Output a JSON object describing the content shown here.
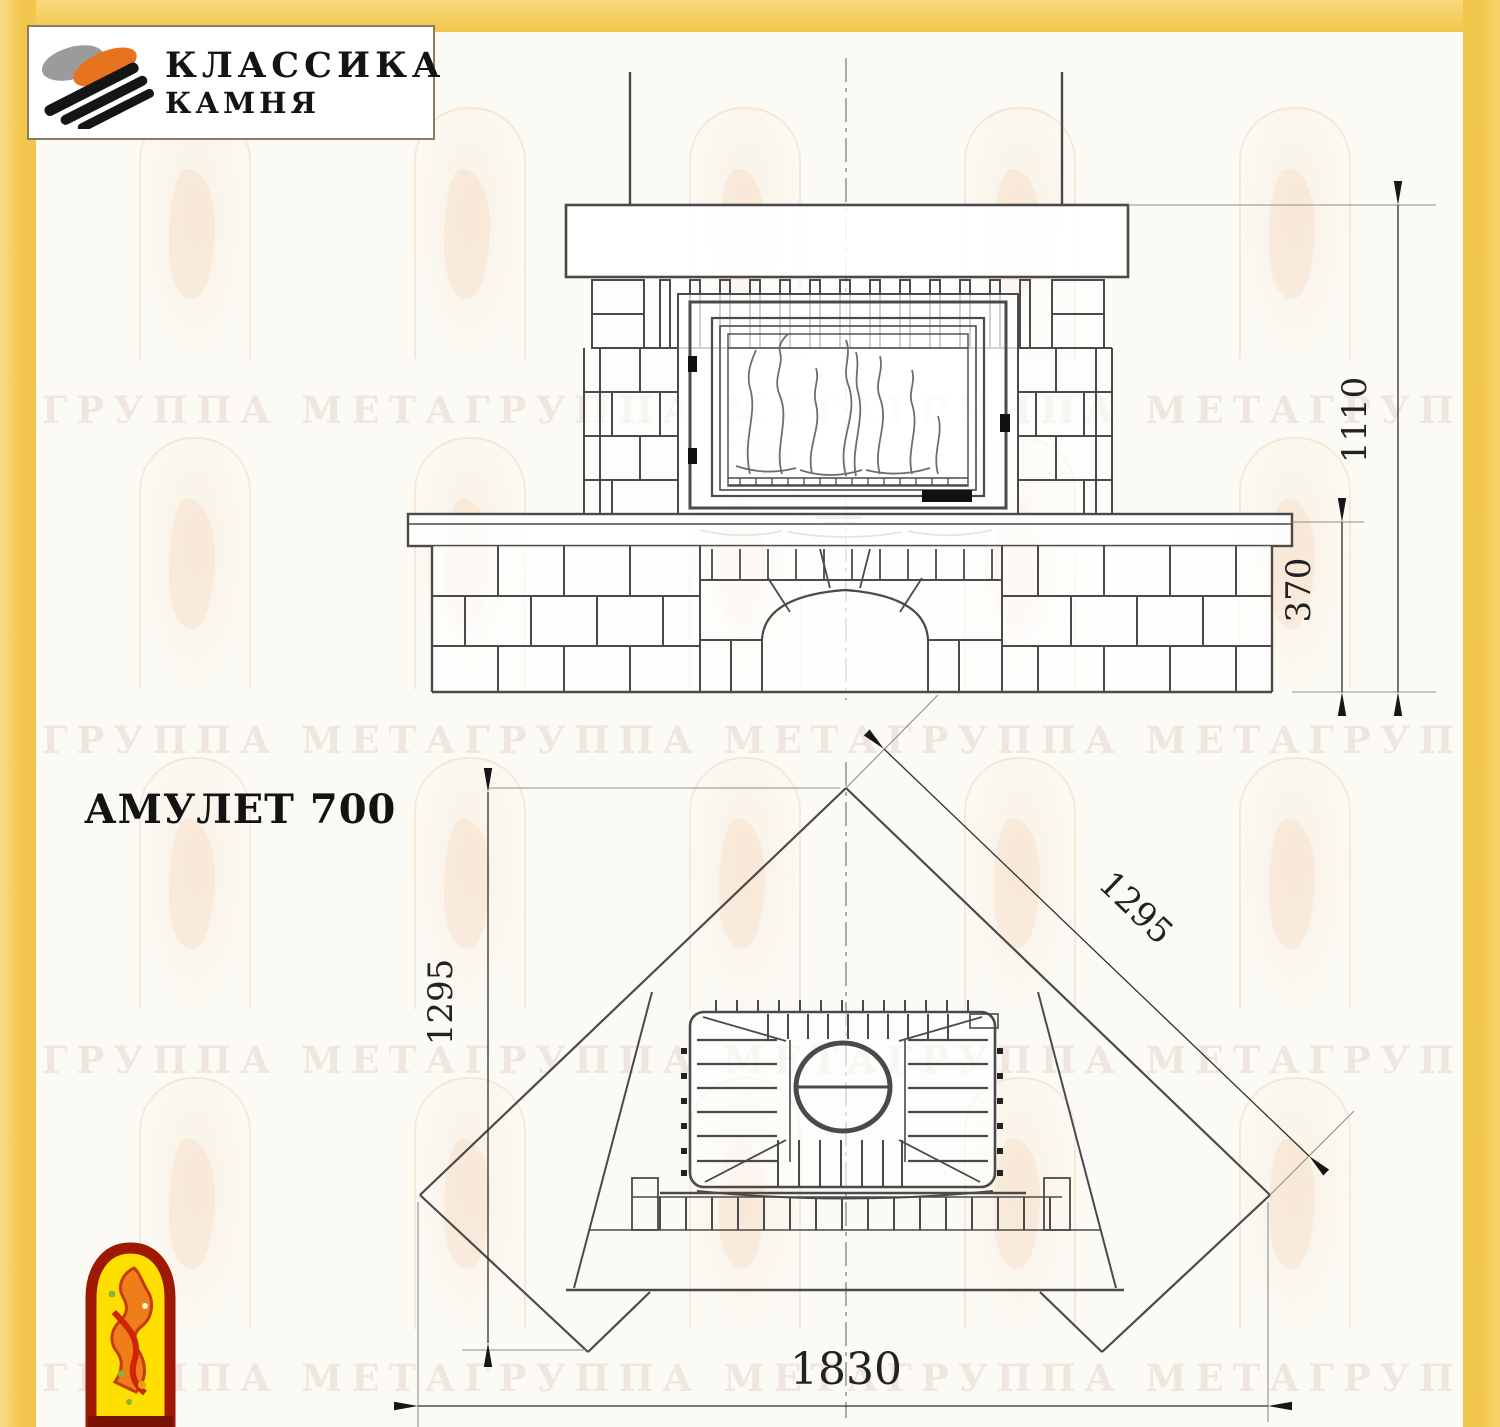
{
  "header": {
    "logo_line1": "КЛАССИКА",
    "logo_line2": "КАМНЯ"
  },
  "title": "АМУЛЕТ 700",
  "watermark": {
    "text": "ГРУППА МЕТАГРУППА МЕТАГРУППА МЕТАГРУППА МЕТАГРУППА МЕТА"
  },
  "front_view": {
    "dims": {
      "total_height": "1110",
      "bench_height": "370"
    }
  },
  "plan_view": {
    "dims": {
      "left_depth": "1295",
      "right_depth": "1295",
      "front_width": "1830"
    }
  },
  "colors": {
    "frame_yellow": "#f2c64c",
    "drawing_line": "#4a4a4a",
    "emblem_red": "#9e1803",
    "emblem_yellow": "#ffdf00",
    "logo_orange": "#e8731e"
  }
}
